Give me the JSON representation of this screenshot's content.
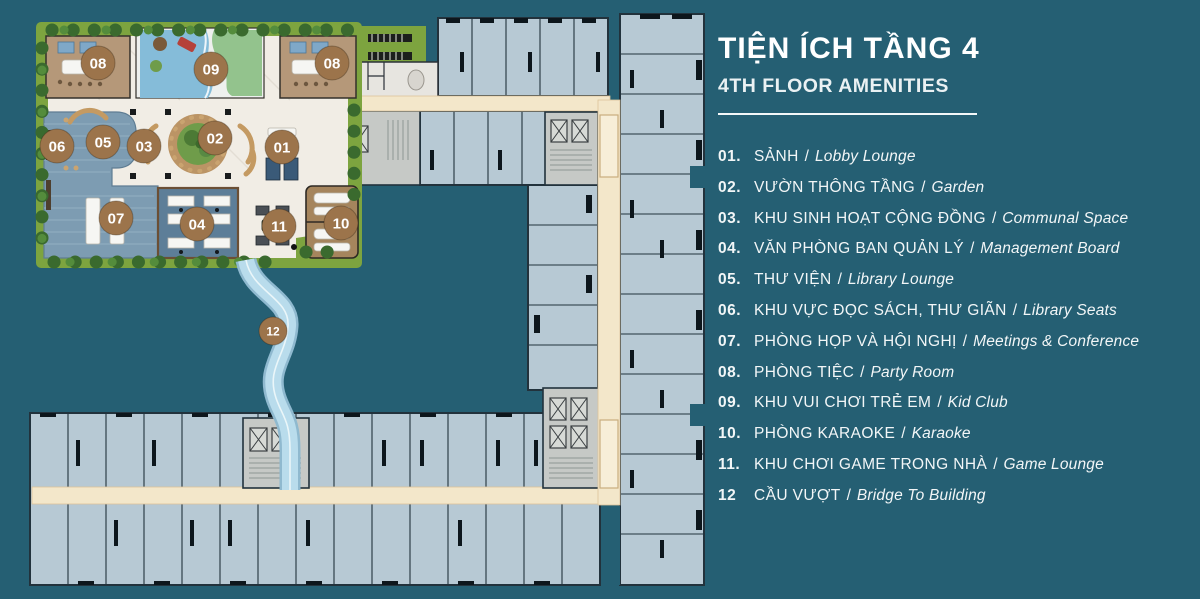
{
  "panel": {
    "title": "TIỆN ÍCH TẦNG 4",
    "subtitle": "4TH FLOOR AMENITIES",
    "separator": "/",
    "items": [
      {
        "num": "01.",
        "vi": "SẢNH",
        "en": "Lobby Lounge"
      },
      {
        "num": "02.",
        "vi": "VƯỜN THÔNG TẦNG",
        "en": "Garden"
      },
      {
        "num": "03.",
        "vi": "KHU SINH HOẠT CỘNG ĐỒNG",
        "en": "Communal Space"
      },
      {
        "num": "04.",
        "vi": "VĂN PHÒNG BAN QUẢN LÝ",
        "en": "Management Board"
      },
      {
        "num": "05.",
        "vi": "THƯ VIỆN",
        "en": "Library Lounge"
      },
      {
        "num": "06.",
        "vi": "KHU VỰC ĐỌC SÁCH, THƯ GIÃN",
        "en": "Library Seats"
      },
      {
        "num": "07.",
        "vi": "PHÒNG HỌP VÀ HỘI NGHỊ",
        "en": "Meetings & Conference"
      },
      {
        "num": "08.",
        "vi": "PHÒNG TIỆC",
        "en": "Party Room"
      },
      {
        "num": "09.",
        "vi": "KHU VUI CHƠI TRẺ EM",
        "en": "Kid Club"
      },
      {
        "num": "10.",
        "vi": "PHÒNG KARAOKE",
        "en": "Karaoke"
      },
      {
        "num": "11.",
        "vi": "KHU CHƠI GAME TRONG NHÀ",
        "en": "Game Lounge"
      },
      {
        "num": "12",
        "vi": "CẦU VƯỢT",
        "en": "Bridge To Building"
      }
    ]
  },
  "plan": {
    "markers": [
      {
        "label": "08",
        "x": 98,
        "y": 63,
        "r": 17
      },
      {
        "label": "09",
        "x": 211,
        "y": 69,
        "r": 17
      },
      {
        "label": "08",
        "x": 332,
        "y": 63,
        "r": 17
      },
      {
        "label": "06",
        "x": 57,
        "y": 146,
        "r": 17
      },
      {
        "label": "05",
        "x": 103,
        "y": 142,
        "r": 17
      },
      {
        "label": "03",
        "x": 144,
        "y": 146,
        "r": 17
      },
      {
        "label": "02",
        "x": 215,
        "y": 138,
        "r": 17
      },
      {
        "label": "01",
        "x": 282,
        "y": 147,
        "r": 17
      },
      {
        "label": "07",
        "x": 116,
        "y": 218,
        "r": 17
      },
      {
        "label": "04",
        "x": 197,
        "y": 224,
        "r": 17
      },
      {
        "label": "11",
        "x": 279,
        "y": 226,
        "r": 17
      },
      {
        "label": "10",
        "x": 341,
        "y": 223,
        "r": 17
      },
      {
        "label": "12",
        "x": 273,
        "y": 331,
        "r": 14
      }
    ],
    "colors": {
      "background": "#255f73",
      "text": "#f2f6f7",
      "marker": "#9c744b",
      "corridor": "#f3e7ca",
      "unit": "#b7c9d4",
      "wall": "#22323c",
      "grass": "#7da43f",
      "plaza": "#f1ede5",
      "wood_room": "#b59879",
      "library_deck": "#7d9cb2",
      "office_room": "#5d7e98",
      "karaoke_room": "#a5855d",
      "pool_blue": "#85bcd9",
      "pool_green": "#93c38d",
      "bridge": "#b9dcec",
      "core_gray": "#c6c9c6"
    }
  }
}
